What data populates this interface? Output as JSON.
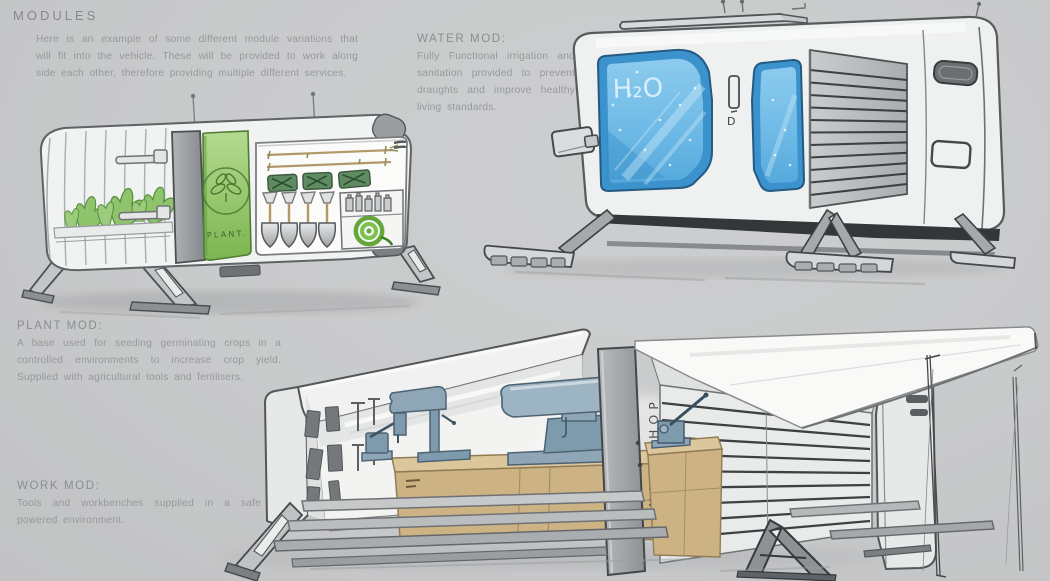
{
  "page": {
    "title": "MODULES",
    "intro": "Here is an example of some different module variations that will fit into the vehicle. These will be provided to work along side each other, therefore providing multiple different services.",
    "background": "#c9cacb",
    "ink_gray": "#96999b"
  },
  "annotations": [
    {
      "id": "water",
      "label": "WATER MOD:",
      "body": "Fully Functional irrigation and sanitation provided to prevent draughts and improve healthy living standards."
    },
    {
      "id": "plant",
      "label": "PLANT MOD:",
      "body": "A base used for seeding germinating crops in a controlled environments to increase crop yield. Supplied with agricultural tools and fertilisers."
    },
    {
      "id": "work",
      "label": "WORK MOD:",
      "body": "Tools and workbenches supplied in a safe powered environment."
    }
  ],
  "sketches": {
    "plant_module": {
      "caption": "Plant module concept sketch",
      "door_label": "PLANT.",
      "emblem_icon": "sprout-leaf-icon",
      "door_green": "#8cc163",
      "sack_green": "#5e8c60",
      "hose_green": "#6cb43f"
    },
    "water_module": {
      "caption": "Water module concept sketch",
      "window_label": "H₂O",
      "door_mark": "D",
      "frame_blue": "#3b92cc",
      "glass_blue": "#7fc3e8"
    },
    "work_module": {
      "caption": "Work module concept sketch",
      "column_label": "WORKSHOP",
      "bench_tan": "#cdb284",
      "machine_blue": "#84a2b6"
    }
  }
}
